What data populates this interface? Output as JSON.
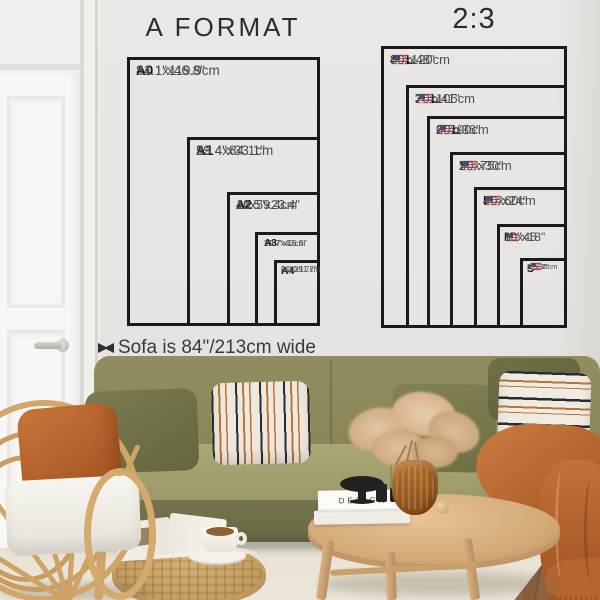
{
  "a_format": {
    "title": "A FORMAT",
    "sizes": [
      {
        "label": "A0",
        "inches": "31.1\"x46.8\"",
        "cm": "84.1x119.9cm"
      },
      {
        "label": "A1",
        "inches": "23.4\"x33.1\"",
        "cm": "59.4x84.1cm"
      },
      {
        "label": "A2",
        "inches": "16.5\"x23.4\"",
        "cm": "42x59.4cm"
      },
      {
        "label": "A3",
        "inches": "11.7\"x16.5\"",
        "cm": "29.7x42cm"
      },
      {
        "label": "A4",
        "inches": "8.3\"x11.7\"",
        "cm": "21x29.7cm"
      }
    ]
  },
  "two_three": {
    "title": "2:3",
    "sizes": [
      {
        "label": "4XL",
        "inches": "32\"x48\"",
        "cm": "80x120cm",
        "flag": "us-flag"
      },
      {
        "label": "3XL",
        "inches": "27\"x41\"",
        "cm": "70x105cm",
        "flag": "us-flag"
      },
      {
        "label": "2XL",
        "inches": "24\"x36\"",
        "cm": "60x90cm",
        "flag": "us-flag"
      },
      {
        "label": "XL",
        "inches": "20\"x30\"",
        "cm": "50x75cm",
        "flag": "us-flag"
      },
      {
        "label": "L",
        "inches": "16\"x24\"",
        "cm": "40x60cm",
        "flag": "us-flag"
      },
      {
        "label": "M",
        "inches": "12\"x18\"",
        "cm": "30x45",
        "flag": "us-flag"
      },
      {
        "label": "S",
        "inches": "8\"x12\"",
        "cm": "20x30cm",
        "flag": "us-flag"
      }
    ]
  },
  "sofa_note": {
    "label": "Sofa is 84\"/213cm wide"
  },
  "decor": {
    "book_title": "DESIGN"
  },
  "colors": {
    "chart_line": "#1a1a1a",
    "wall": "#e8e5e2",
    "sofa_olive": "#8d8a5c",
    "rust_accent": "#bf6c34",
    "wood": "#d2a876",
    "rug": "#e9e4d6"
  }
}
